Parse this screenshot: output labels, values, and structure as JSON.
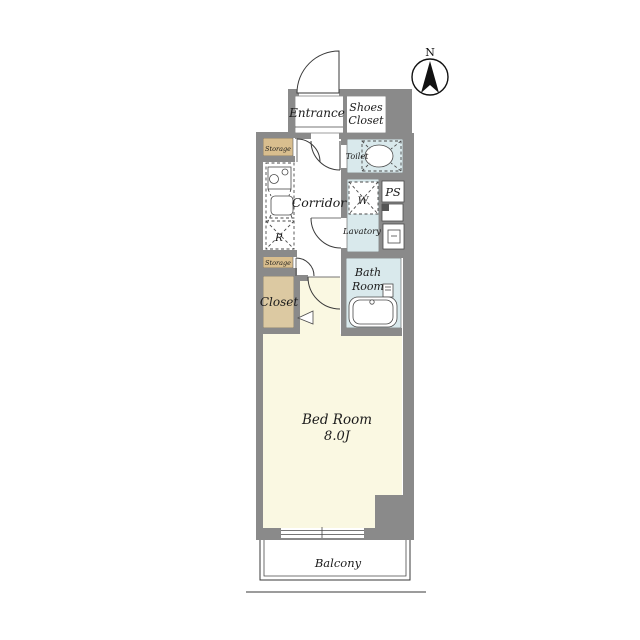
{
  "compass": {
    "north_label": "N"
  },
  "rooms": {
    "entrance": {
      "label": "Entrance"
    },
    "shoes_closet": {
      "line1": "Shoes",
      "line2": "Closet"
    },
    "toilet": {
      "label": "Toilet"
    },
    "corridor": {
      "label": "Corridor"
    },
    "washing_machine": {
      "label": "W"
    },
    "pipe_space": {
      "label": "PS"
    },
    "lavatory": {
      "label": "Lavatory"
    },
    "bath_room": {
      "line1": "Bath",
      "line2": "Room"
    },
    "storage_upper": {
      "label": "Storage"
    },
    "refrigerator": {
      "label": "R"
    },
    "storage_lower": {
      "label": "Storage"
    },
    "closet": {
      "label": "Closet"
    },
    "bed_room": {
      "name": "Bed Room",
      "size": "8.0J"
    },
    "balcony": {
      "label": "Balcony"
    }
  },
  "colors": {
    "wall": "#8A8A8A",
    "wet_area": "#D9E9EC",
    "storage": "#D9BE8E",
    "closet": "#DCC9A2",
    "bedroom_floor": "#FAF8E2",
    "floor_white": "#FFFFFF",
    "line": "#3A3A3A"
  }
}
